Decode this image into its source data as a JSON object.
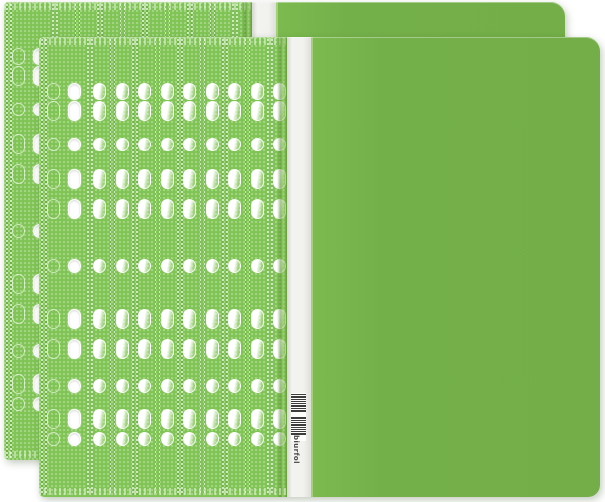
{
  "scene": {
    "description": "Two bright-green A4 plastic report files / flat files with multi-punched filing strips, stacked and offset on a white background",
    "background_color": "#ffffff"
  },
  "colors": {
    "cover_green": "#74b04a",
    "pattern_green": "#80c455",
    "pattern_dot_light": "#a6dc81",
    "perforation_dark": "#508c2d",
    "spine_white": "#f1f1ee",
    "hole_white": "#ffffff",
    "fold_shadow_green": "#5f9c36",
    "barcode_dark": "#3d3d3d",
    "logo_text_color": "#4a4a4a"
  },
  "folders": [
    {
      "role": "back",
      "x": 4,
      "y": 2,
      "width": 561,
      "height": 458,
      "has_barcode": false
    },
    {
      "role": "front",
      "x": 39,
      "y": 37,
      "width": 561,
      "height": 460,
      "has_barcode": true
    }
  ],
  "punch_pattern": {
    "strip_width": 248,
    "margin_width": 46,
    "outline_hole_x": 8,
    "punched_hole_x": 29,
    "column_hole_x": 8,
    "column_width": 22.5,
    "column_count": 9,
    "rows": [
      {
        "type": "pill",
        "y": 46,
        "h": 17
      },
      {
        "type": "pill",
        "y": 64,
        "h": 20
      },
      {
        "type": "circle",
        "y": 101,
        "h": 13
      },
      {
        "type": "pill",
        "y": 132,
        "h": 20
      },
      {
        "type": "pill",
        "y": 162,
        "h": 20
      },
      {
        "type": "circle",
        "y": 222,
        "h": 14
      },
      {
        "type": "pill",
        "y": 272,
        "h": 20
      },
      {
        "type": "pill",
        "y": 302,
        "h": 20
      },
      {
        "type": "circle",
        "y": 342,
        "h": 14
      },
      {
        "type": "pill",
        "y": 372,
        "h": 20
      },
      {
        "type": "circle",
        "y": 395,
        "h": 14
      }
    ]
  },
  "spine": {
    "logo_text": "biurfol",
    "barcode_groups": [
      [
        1,
        2,
        1,
        1,
        1,
        2,
        1,
        2
      ],
      [
        2,
        1,
        1,
        2,
        1,
        1,
        1,
        2
      ]
    ]
  }
}
